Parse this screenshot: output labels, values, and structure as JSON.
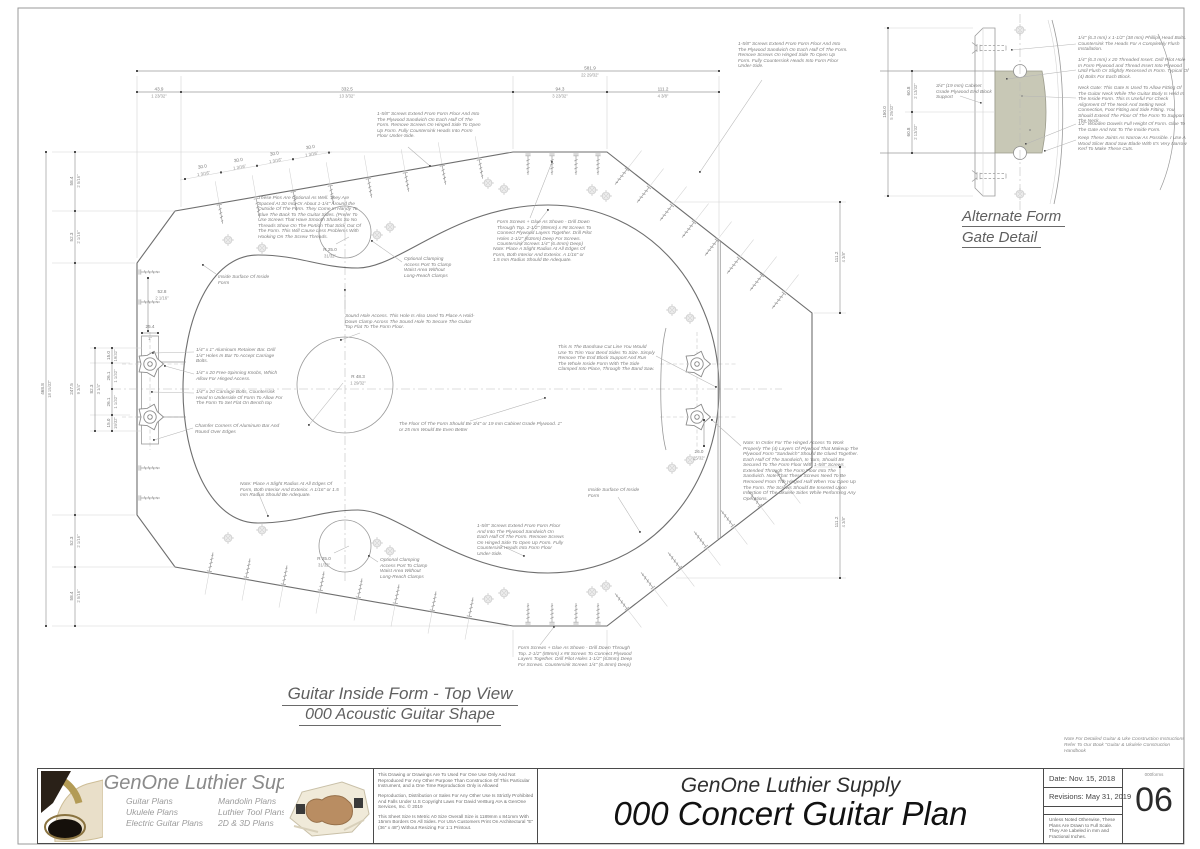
{
  "colors": {
    "line": "#9a9a9a",
    "dark": "#6e6e6e",
    "faint": "#d2d2d2",
    "accent_block": "#c8c8b6",
    "text_gray": "#7f7f7f",
    "title_dark": "#111111"
  },
  "captions": {
    "main1": "Guitar Inside Form - Top View",
    "main2": "000 Acoustic Guitar Shape",
    "detail1": "Alternate Form",
    "detail2": "Gate Detail"
  },
  "main": {
    "annotations": [
      "1-5/8\" Screws Extend From Form Floor And Into The Plywood Sandwich On Each Half Of The Form. Remove Screws On Hinged Side To Open Up Form. Fully Countersink Heads Into Form Floor Under-Side.",
      "These Pins Are Optional As Well. They Are Spaced At 30 mm Or About 1-1/4\" Around the Outside Of The Form. They Come In Handy To Glue The Back To The Guitar Sides. (Prefer To Use Screws That Have Smooth Shanks So No Threads Show On The Portion That Stick Out Of The Form. This Will Cause Less Problems With Hooking On The Screw Threads.",
      "Form Screws + Glue As Shown - Drill Down Through Top. 2-1/2\" (89mm) x #8 Screws To Connect Plywood Layers Together. Drill Pilot Holes 1-1/2\" (63mm) Deep For Screws. Countersink Screws 1/4\" (6.4mm) Deep)",
      "Note: Place A Slight Radius At All Edges Of Form, Both Interior And Exterior. A 1/16\" or 1.5 mm Radius Should Be Adequate.",
      "Inside Surface Of Inside Form",
      "Optional Clamping Access Port To Clamp Waist Area Without Long-Reach Clamps",
      "Sound Hole Access. This Hole Is Also Used To Place A Hold-Down Clamp Across The Sound Hole To Secure The Guitar Top Flat To The Form Floor.",
      "1/4\" x 1\" Aluminum Retainer Bar. Drill 1/4\" Holes In Bar To Accept Carriage Bolts.",
      "1/4\" x 20 Free-Spinning Knobs, Which Allow For Hinged Access.",
      "1/4\" x 20 Carriage Bolts, Countersink Head In Underside Of Form To Allow For The Form To Set Flat On Bench top",
      "Chamfer Corners Of Aluminum Bar And Round Over Edges",
      "This Is The Bandsaw Cut Line You Would Use To Trim Your Bend Sides To Size. Simply Remove The End Block Support And Run The Whole Inside Form With The Side Clamped Into Place, Through The Band Saw.",
      "The Floor Of The Form Should Be 3/4\" or 19 mm Cabinet Grade Plywood. 1\" or 25 mm Would Be Even Better",
      "Note: In Order For The Hinged Access To Work Properly The (4) Layers Of Plywood That Makeup The Plywood Form \"Sandwich\" Should Be Glued Together. Each Half Of The Sandwich, In Turn, Should Be Secured To The Form Floor With 1-5/8\" Screws Extended Through The Form Floor Into The Sandwich. Note That These Screws Need To Be Removed From The Hinged Half When You Open Up The Form. The Screws Should Be Inserted Upon Insertion Of The Ukulele Sides While Performing Any Operations."
    ],
    "dims": {
      "overall_top_mm": "581.9",
      "overall_top_in": "22 29/32\"",
      "top": [
        {
          "mm": "43.9",
          "in": "1 23/32\""
        },
        {
          "mm": "332.5",
          "in": "13 3/32\""
        },
        {
          "mm": "94.3",
          "in": "3 23/32\""
        },
        {
          "mm": "111.2",
          "in": "4 3/8\""
        }
      ],
      "overall_left_mm": "468.8",
      "overall_left_in": "18 15/32\"",
      "left": [
        {
          "mm": "58.4",
          "in": "2 5/16\""
        },
        {
          "mm": "52.3",
          "in": "2 1/16\""
        },
        {
          "mm": "247.5",
          "in": "9 3/4\""
        },
        {
          "mm": "52.3",
          "in": "2 1/16\""
        },
        {
          "mm": "58.4",
          "in": "2 5/16\""
        }
      ],
      "inner_82_mm": "82.3",
      "inner_82_in": "3 1/4\"",
      "inner_15_mm": "15.0",
      "inner_15_in": "19/32\"",
      "inner_26_mm": "26.1",
      "inner_26_in": "1 1/32\"",
      "bar_mm": "25.4",
      "bar_in": "1\"",
      "waist_mm": "52.8",
      "waist_in": "2 1/16\"",
      "right_mm": "111.2",
      "right_in": "4 3/8\"",
      "tail_mm": "26.0",
      "tail_in": "25/32\"",
      "pin_mm": "30.0",
      "pin_in": "1 3/16\"",
      "r_sound_mm": "R 48.3",
      "r_sound_in": "1 29/32\"",
      "r_port_mm": "R 25.0",
      "r_port_in": "31/32\""
    }
  },
  "detail": {
    "annotations": [
      "1/4\" (6.3 mm)  x 1-1/2\" (38 mm) Phillips Head Bolts. Countersink The Heads For A Completely Flush Installation.",
      "1/4\" (6.3 mm) x 20 Threaded Insert. Drill Pilot Hole In Form Plywood and Thread Insert Into Plywood Until Flush Or Slightly Recessed In Form. Typical Of (4) Bolts For Each Block.",
      "Neck Gate: This Gate Is Used To Allow Fitting Of The Guitar Neck While The Guitar Body Is Held In The Inside Form. This Is Useful For Check Alignment Of The Neck And Setting Neck Connection, Foot Fitting and Side Fitting. You Should Extend The Floor Of The Form To Support The Neck.",
      "1/2\" Wooden Dowels Full Height Of Form. Glue To The Gate And Not To The Inside Form.",
      "Keep These Joints As Narrow As Possible. I Use A Wood Slicer Band Saw Blade With It's Very Narrow Kerf To Make These Cuts.",
      "3/4\" (19 mm) Cabinet Grade Plywood End Block Support"
    ],
    "dims": {
      "h_mm": "150.0",
      "h_in": "5 29/32\"",
      "half_mm": "60.8",
      "half_in": "2 13/32\""
    }
  },
  "title_block": {
    "brand": "GenOne Luthier Supplies",
    "plans_col1": [
      "Guitar Plans",
      "Ukulele Plans",
      "Electric Guitar Plans"
    ],
    "plans_col2": [
      "Mandolin Plans",
      "Luthier Tool Plans",
      "2D & 3D Plans"
    ],
    "legal": [
      "This Drawing or Drawings Are To Used For One Use Only And Not Reproduced For Any Other Purpose Than Construction Of This Particular Instrument, and a One Time Reproduction Only is Allowed",
      "Reproduction, Distribution or Sales For Any Other Use Is Strictly Prohibited And Falls Under U.S Copyright Laws For David VerBurg AIA & GenOne Services, Inc.  ©  2019",
      "This Sheet Size Is Metric A0 Size Overall Size is 1189mm x 841mm With 15mm Borders On All Sides. For USA Customers Print On Architectural \"E\" (36\" x 48\") Without Resizing For 1:1 Printout."
    ],
    "company": "GenOne Luthier Supply",
    "plan_title": "000 Concert Guitar Plan",
    "date": "Date: Nov. 15, 2018",
    "revisions": "Revisions: May 31, 2019",
    "scale_note": "Unless Noted Otherwise, These Plans Are Drawn to Full Scale. They Are Labeled in mm and Fractional Inches.",
    "sheet_code": "000forms",
    "sheet_number": "06",
    "book_note": "Note For Detailed Guitar & Uke Construction Instructions Refer To Our Book \"Guitar & Ukulele Construction Handbook"
  }
}
